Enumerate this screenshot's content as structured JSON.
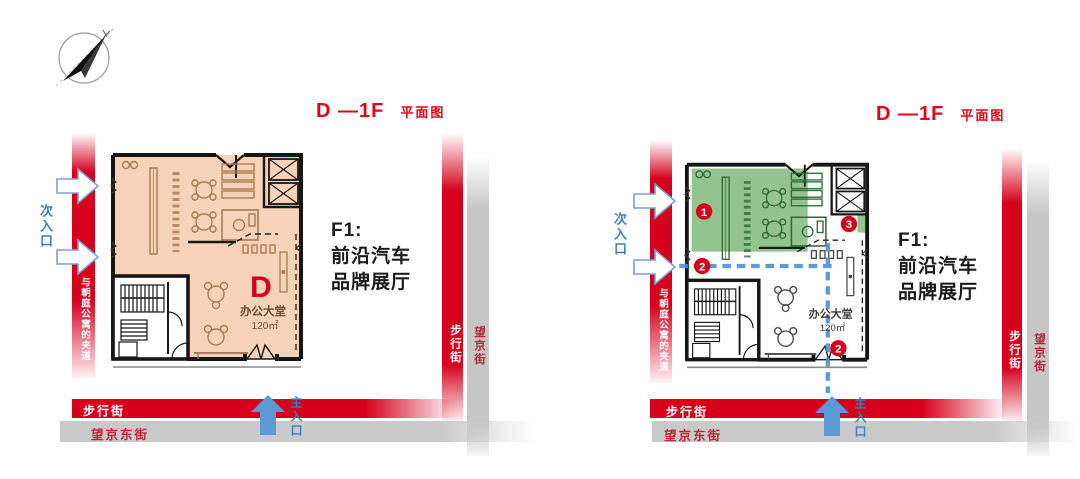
{
  "colors": {
    "accent_red": "#d6001c",
    "title_red": "#e60019",
    "street_gray": "#c9c9c9",
    "plan_orange": "#f6d3b8",
    "plan_green": "#93c48f",
    "entrance_blue": "#5b9bd5",
    "route_blue": "#4a90d9",
    "label_blue": "#3f7fc1"
  },
  "compass": {
    "icon": "north-arrow-compass"
  },
  "panels": {
    "left": {
      "title": "D —1F",
      "subtitle": "平面图",
      "annotation": {
        "line1": "F1:",
        "line2": "前沿汽车",
        "line3": "品牌展厅"
      },
      "plan": {
        "unit": "D",
        "room": "办公大堂",
        "area": "120㎡"
      },
      "labels": {
        "secondary_entrance": "次入口",
        "main_entrance": "主入口",
        "alley": "与朝庭公寓的夹道",
        "pedestrian_street": "步行街",
        "wangjing_east_street": "望京东街",
        "pedestrian_street_right": "步行街",
        "wangjing_street": "望京街"
      }
    },
    "right": {
      "title": "D —1F",
      "subtitle": "平面图",
      "annotation": {
        "line1": "F1:",
        "line2": "前沿汽车",
        "line3": "品牌展厅"
      },
      "plan": {
        "room": "办公大堂",
        "area": "120㎡"
      },
      "markers": {
        "m1": "1",
        "m2": "2",
        "m3": "3",
        "m2b": "2"
      },
      "labels": {
        "secondary_entrance": "次入口",
        "main_entrance": "主入口",
        "alley": "与朝庭公寓的夹道",
        "pedestrian_street": "步行街",
        "wangjing_east_street": "望京东街",
        "pedestrian_street_right": "步行街",
        "wangjing_street": "望京街"
      }
    }
  }
}
